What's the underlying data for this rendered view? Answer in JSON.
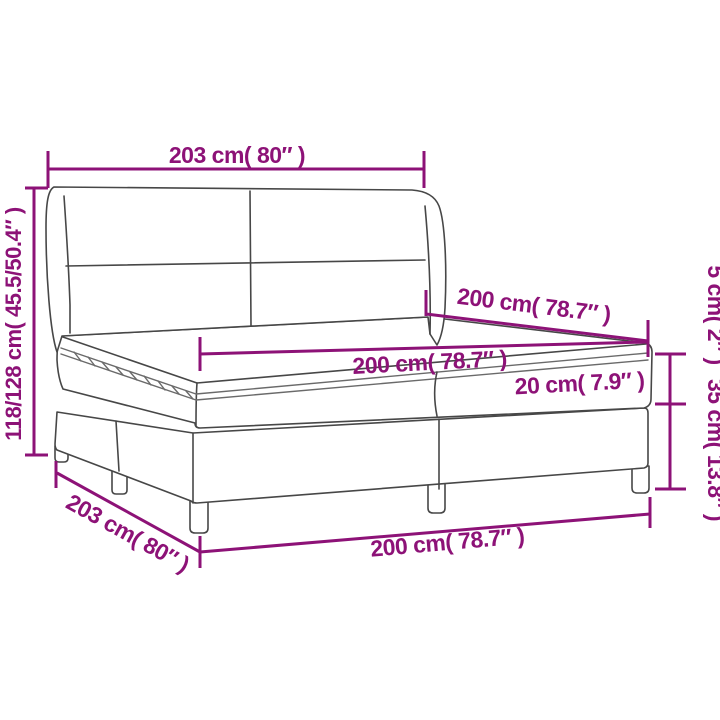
{
  "diagram": {
    "title": "box-spring-bed-with-winged-headboard-dimension-drawing",
    "colors": {
      "dimension_accent": "#8D1277",
      "line_art": "#474747",
      "background": "#FFFFFF"
    },
    "dimensions": {
      "headboard_width_top": {
        "label": "203 cm( 80″ )"
      },
      "total_height_left": {
        "label": "118/128 cm( 45.5/50.4″ )"
      },
      "bed_length_depth": {
        "label": "200 cm( 78.7″ )"
      },
      "mattress_width": {
        "label": "200 cm( 78.7″ )"
      },
      "mattress_height": {
        "label": "20 cm( 7.9″ )"
      },
      "topper_height_right": {
        "label": "5 cm( 2″ )"
      },
      "base_height_right": {
        "label": "35 cm( 13.8″ )"
      },
      "base_depth_diagonal": {
        "label": "203 cm( 80″ )"
      },
      "base_width_bottom": {
        "label": "200 cm( 78.7″ )"
      }
    }
  }
}
